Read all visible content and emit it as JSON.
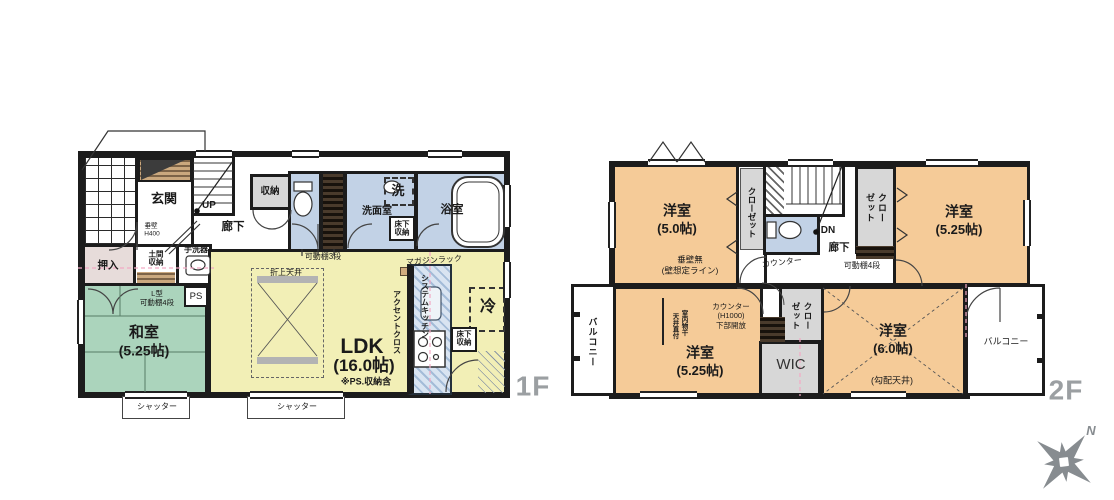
{
  "meta": {
    "type": "floor-plan",
    "floors": [
      "1F",
      "2F"
    ],
    "colors": {
      "wall": "#1c1c1c",
      "tatami_green": "#abd4bc",
      "ldk_yellow": "#f2efb6",
      "room_orange": "#f5cb98",
      "wet_blue": "#c2d2e6",
      "storage_gray": "#d7d7d7",
      "floor_label_gray": "#9b9fa2",
      "measure_pink": "#f2a9c4"
    }
  },
  "f1": {
    "label": "1F",
    "genkan": "玄関",
    "up": "UP",
    "shunou": "収納",
    "rouka": "廊下",
    "tarekabe_l1": "垂壁",
    "tarekabe_l2": "H400",
    "oshiire": "押入",
    "doma": "土間収納",
    "tearai": "手洗器",
    "ps": "PS",
    "lshelf_l1": "L型",
    "lshelf_l2": "可動棚4段",
    "washitsu": "和室",
    "washitsu_size": "(5.25帖)",
    "shutter": "シャッター",
    "kadou3": "可動棚3段",
    "oriage": "折上天井",
    "magazine": "マガジンラック",
    "accent": "アクセントクロス",
    "kitchen": "システムキッチン",
    "ldk": "LDK",
    "ldk_size": "(16.0帖)",
    "ldk_note": "※PS.収納含",
    "rei": "冷",
    "yukashita": "床下収納",
    "senmen": "洗面室",
    "sen": "洗",
    "yoku": "浴室"
  },
  "f2": {
    "label": "2F",
    "y50": "洋室",
    "y50_size": "(5.0帖)",
    "closet": "クローゼット",
    "dn": "DN",
    "rouka": "廊下",
    "kadou4": "可動棚4段",
    "counter": "カウンター",
    "y525": "洋室",
    "y525_size": "(5.25帖)",
    "tare_l1": "垂壁無",
    "tare_l2": "(壁想定ライン)",
    "balcony": "バルコニー",
    "monohoshi_l1": "室内物干",
    "monohoshi_l2": "天井直付",
    "counterh_l1": "カウンター",
    "counterh_l2": "(H1000)",
    "counterh_l3": "下部開放",
    "wic": "WIC",
    "y60": "洋室",
    "y60_size": "(6.0帖)",
    "kobai": "(勾配天井)"
  },
  "compass": {
    "n": "N"
  }
}
